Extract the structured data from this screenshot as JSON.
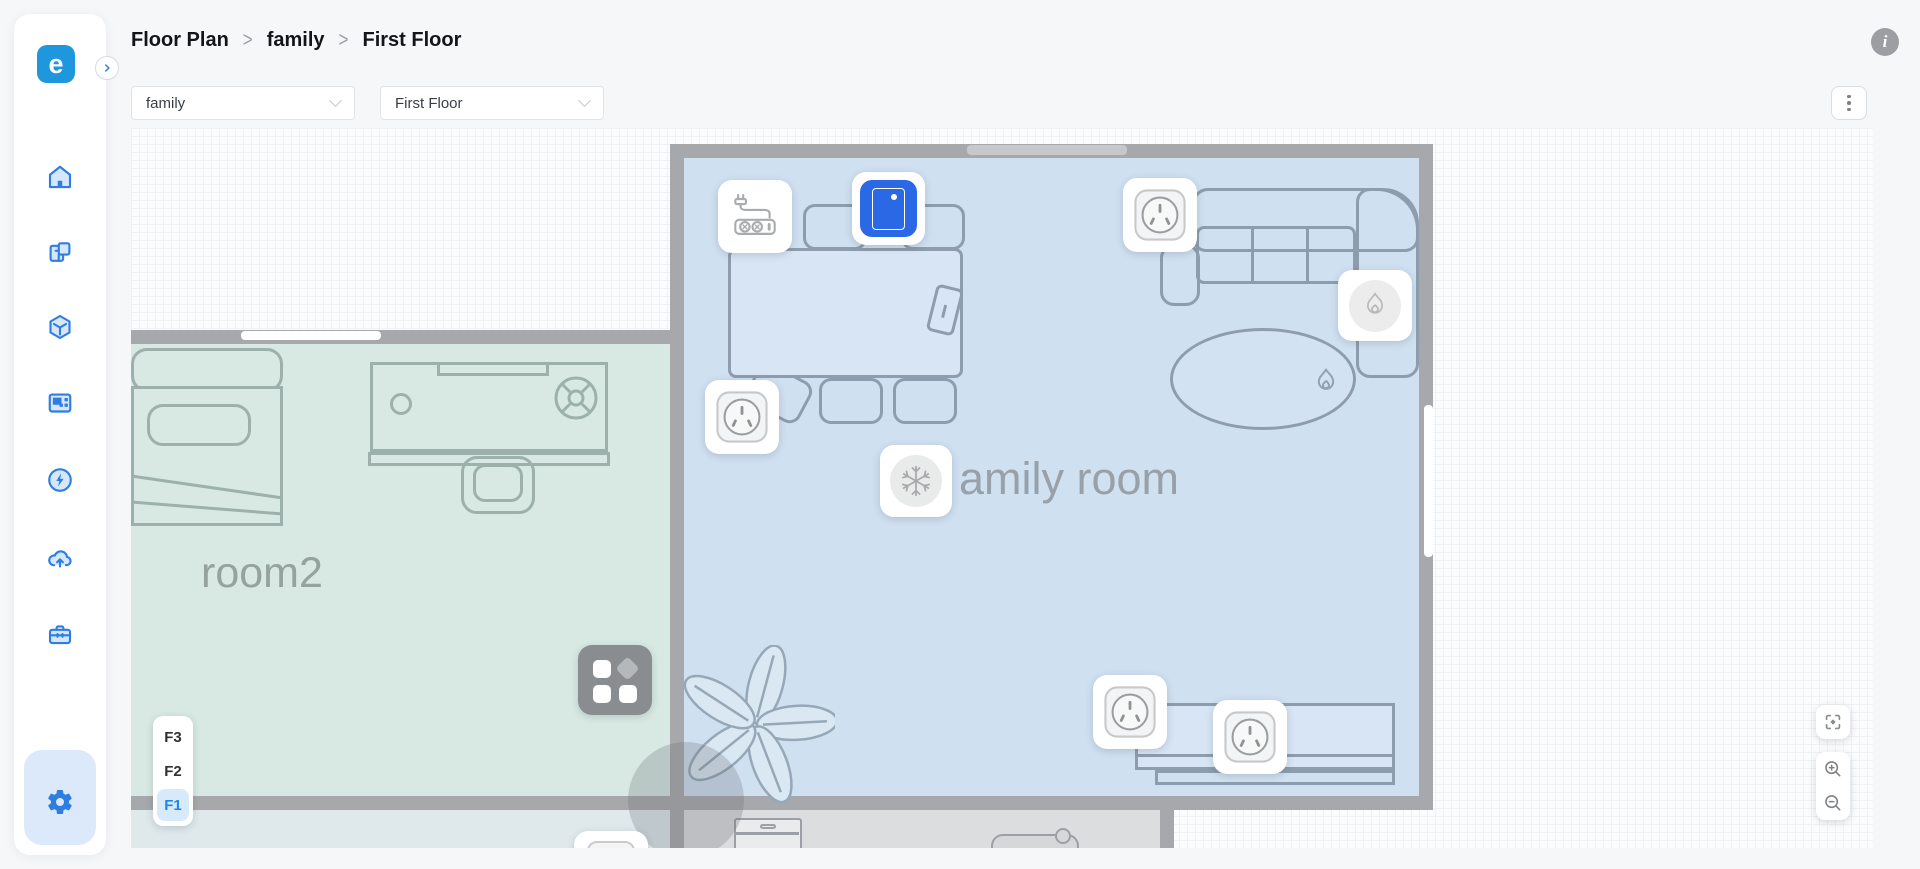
{
  "app": {
    "logo_letter": "e"
  },
  "sidebar": {
    "items": [
      {
        "name": "home"
      },
      {
        "name": "floor-plan"
      },
      {
        "name": "spaces-3d"
      },
      {
        "name": "dashboard"
      },
      {
        "name": "energy"
      },
      {
        "name": "cloud-upload"
      },
      {
        "name": "toolbox"
      }
    ],
    "settings": {
      "name": "settings"
    }
  },
  "header": {
    "breadcrumb": [
      "Floor Plan",
      "family",
      "First Floor"
    ],
    "info_glyph": "i"
  },
  "toolbar": {
    "home_select": {
      "value": "family"
    },
    "floor_select": {
      "value": "First Floor"
    }
  },
  "floor_switcher": {
    "floors": [
      {
        "label": "F3",
        "active": false
      },
      {
        "label": "F2",
        "active": false
      },
      {
        "label": "F1",
        "active": true
      }
    ]
  },
  "canvas": {
    "rooms": [
      {
        "name": "room2"
      },
      {
        "name": "amily room"
      }
    ],
    "devices": [
      "power-strip",
      "wall-panel",
      "socket",
      "heater",
      "socket",
      "air-conditioner",
      "scene-switch",
      "socket",
      "socket"
    ]
  },
  "colors": {
    "accent": "#2e7de2",
    "logo": "#1e97dc",
    "panel_device_blue": "#2a68e6",
    "room_blue_fill": "#cfe0f1",
    "room_green_fill": "#d8e9e3",
    "wall": "#a6a8ab",
    "active_floor_bg": "#d7eafc",
    "active_floor_text": "#1b87ea"
  }
}
